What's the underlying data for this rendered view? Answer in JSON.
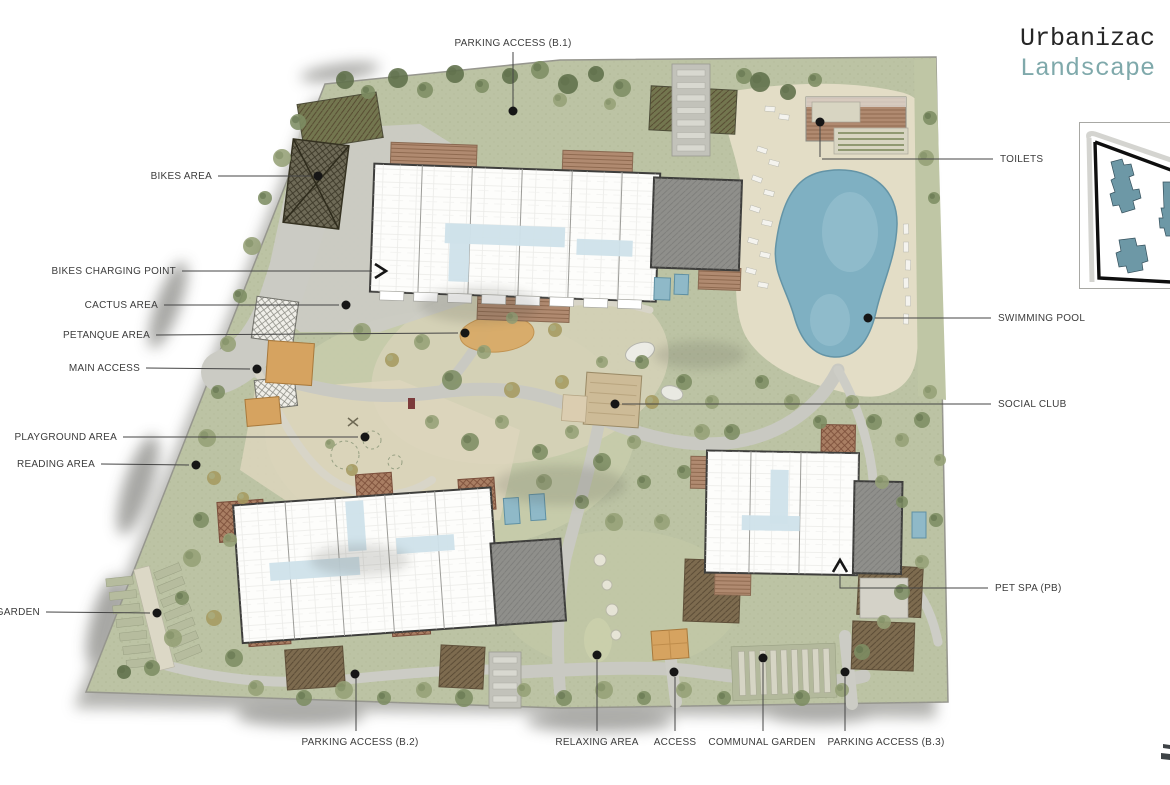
{
  "title": {
    "line1": "Urbanizac",
    "line2": "Landscape"
  },
  "callouts": {
    "parking_b1": "PARKING ACCESS (B.1)",
    "bikes_area": "BIKES AREA",
    "bikes_charging": "BIKES CHARGING POINT",
    "cactus": "CACTUS AREA",
    "petanque": "PETANQUE AREA",
    "main_access": "MAIN ACCESS",
    "playground": "PLAYGROUND AREA",
    "reading": "READING AREA",
    "garden": "GARDEN",
    "parking_b2": "PARKING ACCESS (B.2)",
    "relaxing": "RELAXING AREA",
    "access": "ACCESS",
    "communal_garden": "COMMUNAL GARDEN",
    "parking_b3": "PARKING ACCESS (B.3)",
    "pet_spa": "PET SPA (PB)",
    "social_club": "SOCIAL CLUB",
    "swimming_pool": "SWIMMING POOL",
    "toilets": "TOILETS"
  },
  "colors": {
    "title_accent": "#7fa9ab",
    "site_green": "#bcc3a4",
    "pool_blue": "#7fb0c2",
    "keymap_building": "#6d98a6",
    "label_text": "#3c3c3c"
  }
}
